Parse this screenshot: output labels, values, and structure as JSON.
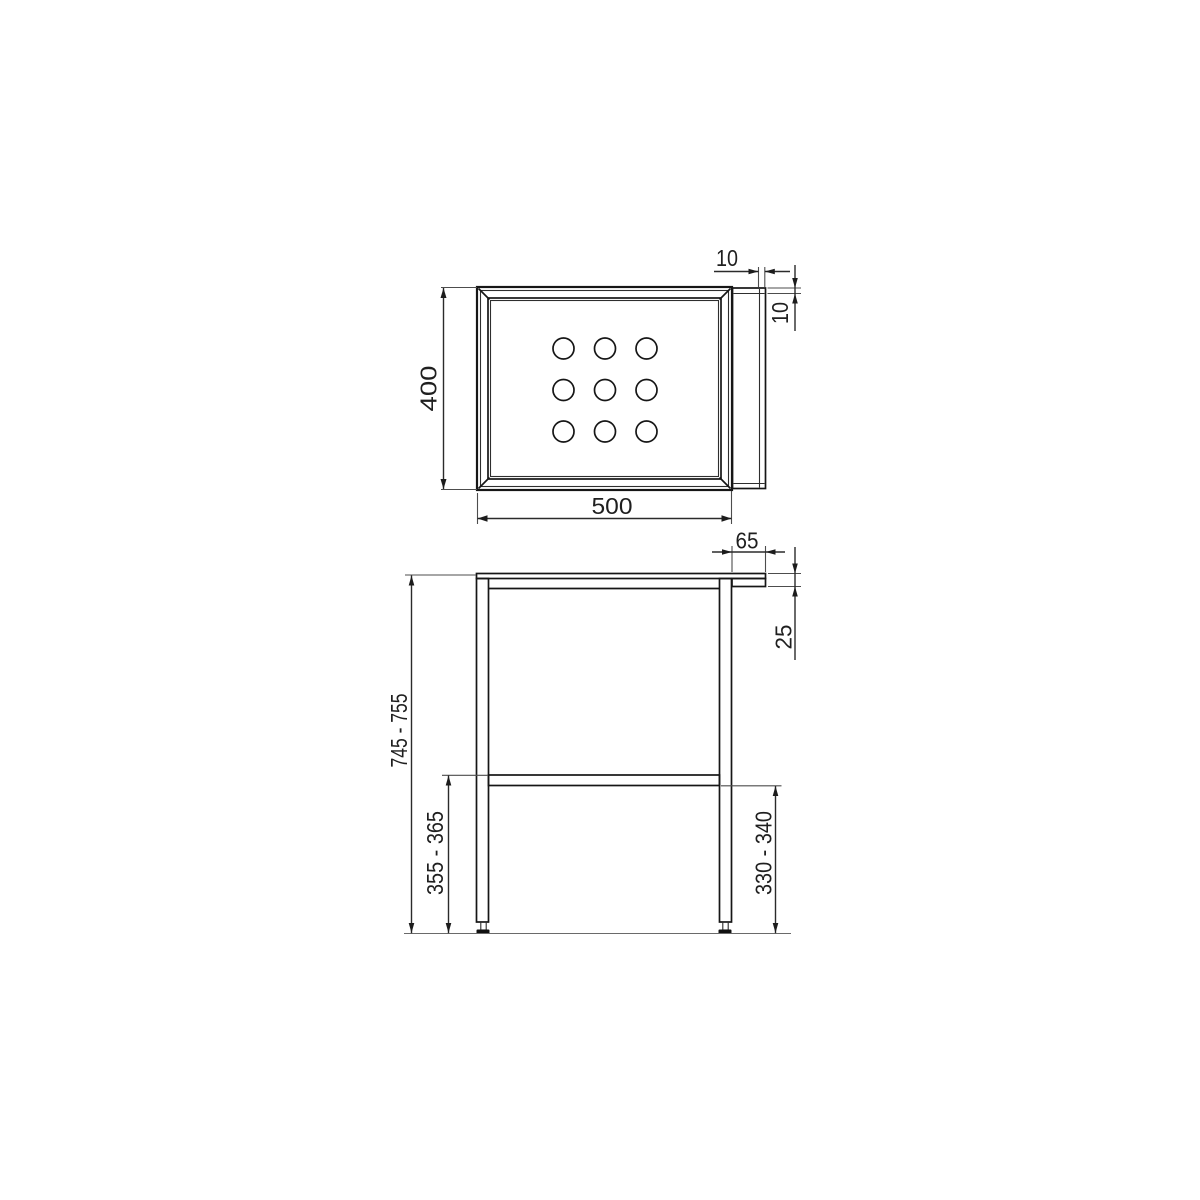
{
  "colors": {
    "background": "#ffffff",
    "object_line": "#161616",
    "dim_line": "#2b2b2b",
    "ext_line": "#4d4d4d",
    "text": "#1f1f1f",
    "floor_line": "#6a6a6a"
  },
  "top_view": {
    "depth_dim": "400",
    "width_dim": "500",
    "flange_width_dim": "10",
    "flange_offset_dim": "10",
    "hole_grid_rows": 3,
    "hole_grid_cols": 3
  },
  "front_view": {
    "bracket_depth_dim": "65",
    "top_thickness_dim": "25",
    "overall_height_dim": "745 - 755",
    "rail_height_top_dim": "355 - 365",
    "rail_height_bottom_dim": "330 - 340"
  }
}
